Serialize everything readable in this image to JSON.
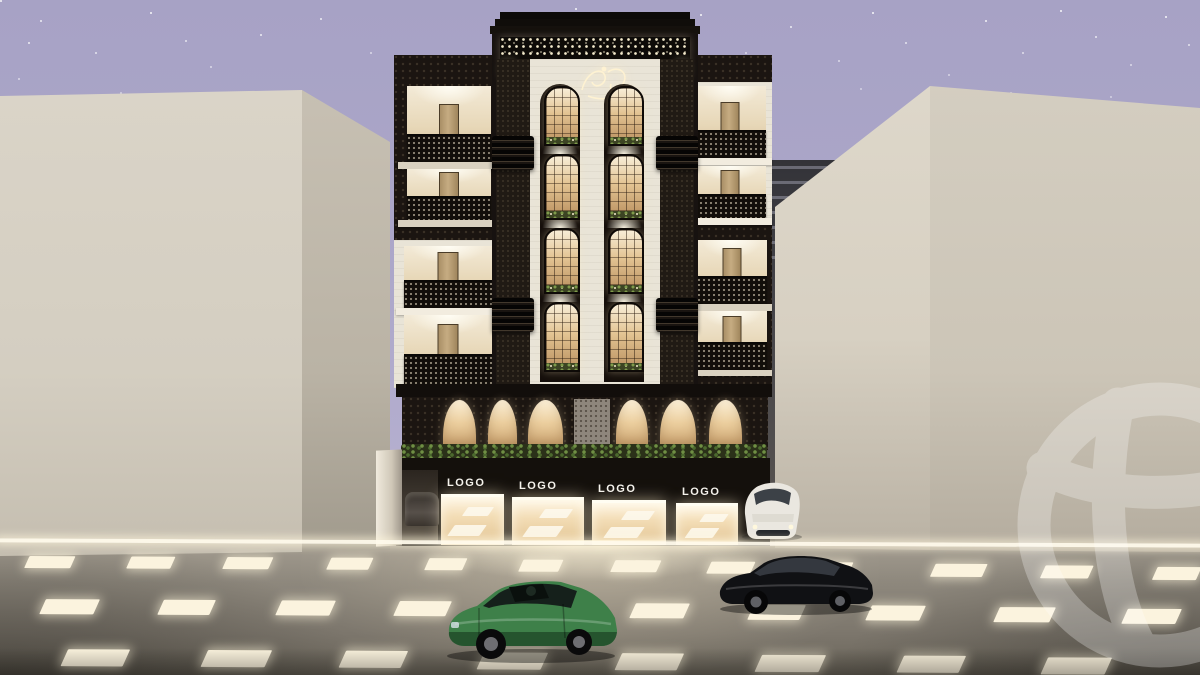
{
  "scene": {
    "title": "Night-time architectural exterior render of an ornate apartment building with retail ground floor",
    "sky": "starry dusk sky",
    "street": "asphalt road with glowing lane markings",
    "vehicles": [
      "green sedan",
      "black sedan",
      "white parked sedan",
      "dark car in garage"
    ],
    "watermark_icon": "dribbble-ball-watermark",
    "facade_emblem": "illuminated-calligraphy-emblem"
  },
  "palette": {
    "sky": "#aba6c8",
    "facade_dark": "#1b1511",
    "facade_white": "#e9e4d7",
    "window_glow": "#f3ddb6",
    "neighbor_building": "#d5cfc2",
    "street": "#8e887d",
    "lane_marking": "#fbf3de",
    "car_green": "#3e8049",
    "car_black": "#131417",
    "car_white": "#eae7e0"
  },
  "ground_floor": {
    "storefronts": [
      {
        "label": "LOGO"
      },
      {
        "label": "LOGO"
      },
      {
        "label": "LOGO"
      },
      {
        "label": "LOGO"
      }
    ]
  }
}
